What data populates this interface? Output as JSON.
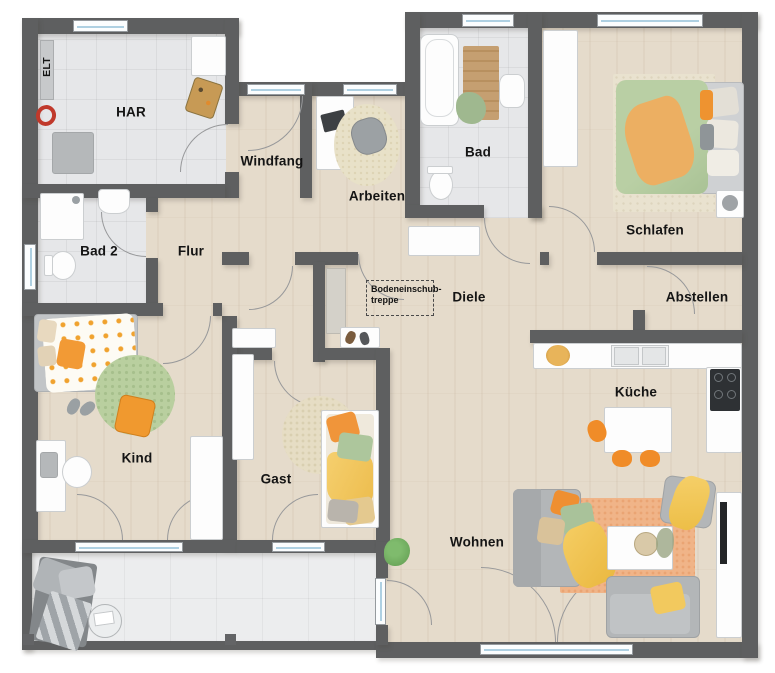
{
  "rooms": [
    {
      "id": "elt",
      "label": "ELT"
    },
    {
      "id": "har",
      "label": "HAR"
    },
    {
      "id": "windfang",
      "label": "Windfang"
    },
    {
      "id": "arbeiten",
      "label": "Arbeiten"
    },
    {
      "id": "bad",
      "label": "Bad"
    },
    {
      "id": "schlafen",
      "label": "Schlafen"
    },
    {
      "id": "bad2",
      "label": "Bad 2"
    },
    {
      "id": "flur",
      "label": "Flur"
    },
    {
      "id": "diele",
      "label": "Diele"
    },
    {
      "id": "abstellen",
      "label": "Abstellen"
    },
    {
      "id": "kind",
      "label": "Kind"
    },
    {
      "id": "gast",
      "label": "Gast"
    },
    {
      "id": "kueche",
      "label": "Küche"
    },
    {
      "id": "wohnen",
      "label": "Wohnen"
    }
  ],
  "annotations": {
    "attic_ladder_line1": "Bodeneinschub-",
    "attic_ladder_line2": "treppe"
  },
  "palette": {
    "wall": "#5e5f60",
    "wood_floor": "#e5dbcb",
    "tile_floor": "#e6e7e9",
    "terrace_floor": "#ecedee",
    "furniture_white": "#fdfdfd",
    "furniture_gray": "#b5b8ba",
    "accent_orange": "#f0953a",
    "accent_green": "#a9c29a",
    "accent_yellow": "#f2c558",
    "rug_orange": "#f0b488",
    "window_glass": "#aed0e2"
  }
}
